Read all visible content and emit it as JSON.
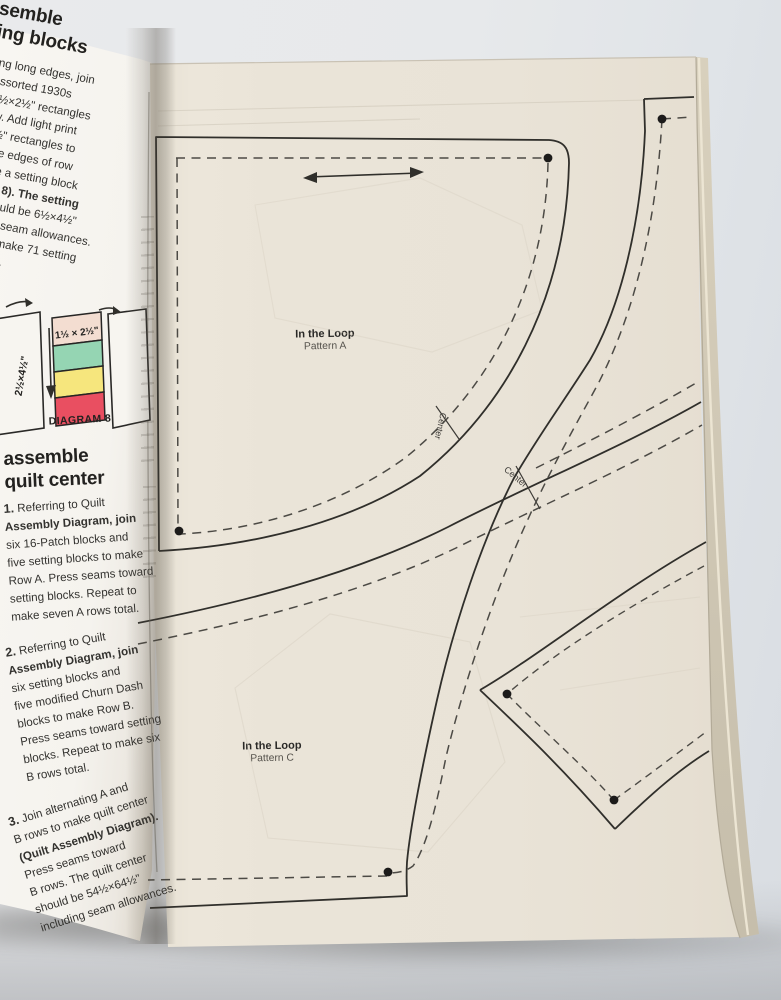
{
  "photo": {
    "background": "#e7e9eb",
    "right_page_paper": "#eae4d8",
    "left_page_paper": "#f7f5f1",
    "pattern_line": "#302f2b",
    "diagram8_colors": {
      "top_cell": "#f3ddd1",
      "green_cell": "#95d5b3",
      "yellow_cell": "#f6e67d",
      "red_cell": "#e94f61"
    }
  },
  "left_page": {
    "heading_top_line1": "ssemble",
    "heading_top_line2": "tting blocks",
    "intro_lines": [
      "gning long edges, join",
      "ur assorted 1930s",
      "int 1½×2½\" rectangles",
      "a row. Add light print",
      "½×4½\" rectangles to",
      "pposite edges of row",
      "o make a setting block",
      "iagram 8). The setting",
      "lock should be 6½×4½\"",
      "ncluding seam allowances.",
      "epeat to make 71 setting",
      "locks total."
    ],
    "diagram8": {
      "left_rect_label": "2½×4½\"",
      "stack_label": "1½ × 2½\"",
      "caption": "DIAGRAM 8"
    },
    "heading_mid_line1": "assemble",
    "heading_mid_line2": "quilt center",
    "step1_num": "1.",
    "step1_lines": [
      "Referring to Quilt",
      "Assembly Diagram, join",
      "six 16-Patch blocks and",
      "five setting blocks to make",
      "Row A. Press seams toward",
      "setting blocks. Repeat to",
      "make seven A rows total."
    ],
    "step2_num": "2.",
    "step2_lines": [
      "Referring to Quilt",
      "Assembly Diagram, join",
      "six setting blocks and",
      "five modified Churn Dash",
      "blocks to make Row B.",
      "Press seams toward setting",
      "blocks. Repeat to make six",
      "B rows total."
    ],
    "step3_num": "3.",
    "step3_lines": [
      "Join alternating A and",
      "B rows to make quilt center",
      "(Quilt Assembly Diagram).",
      "Press seams toward",
      "B rows. The quilt center",
      "should be 54½×64½\"",
      "including seam allowances."
    ]
  },
  "right_page": {
    "pattern_a_title": "In the Loop",
    "pattern_a_sub": "Pattern A",
    "pattern_c_title": "In the Loop",
    "pattern_c_sub": "Pattern C",
    "center_label_1": "Center",
    "center_label_2": "Center"
  }
}
